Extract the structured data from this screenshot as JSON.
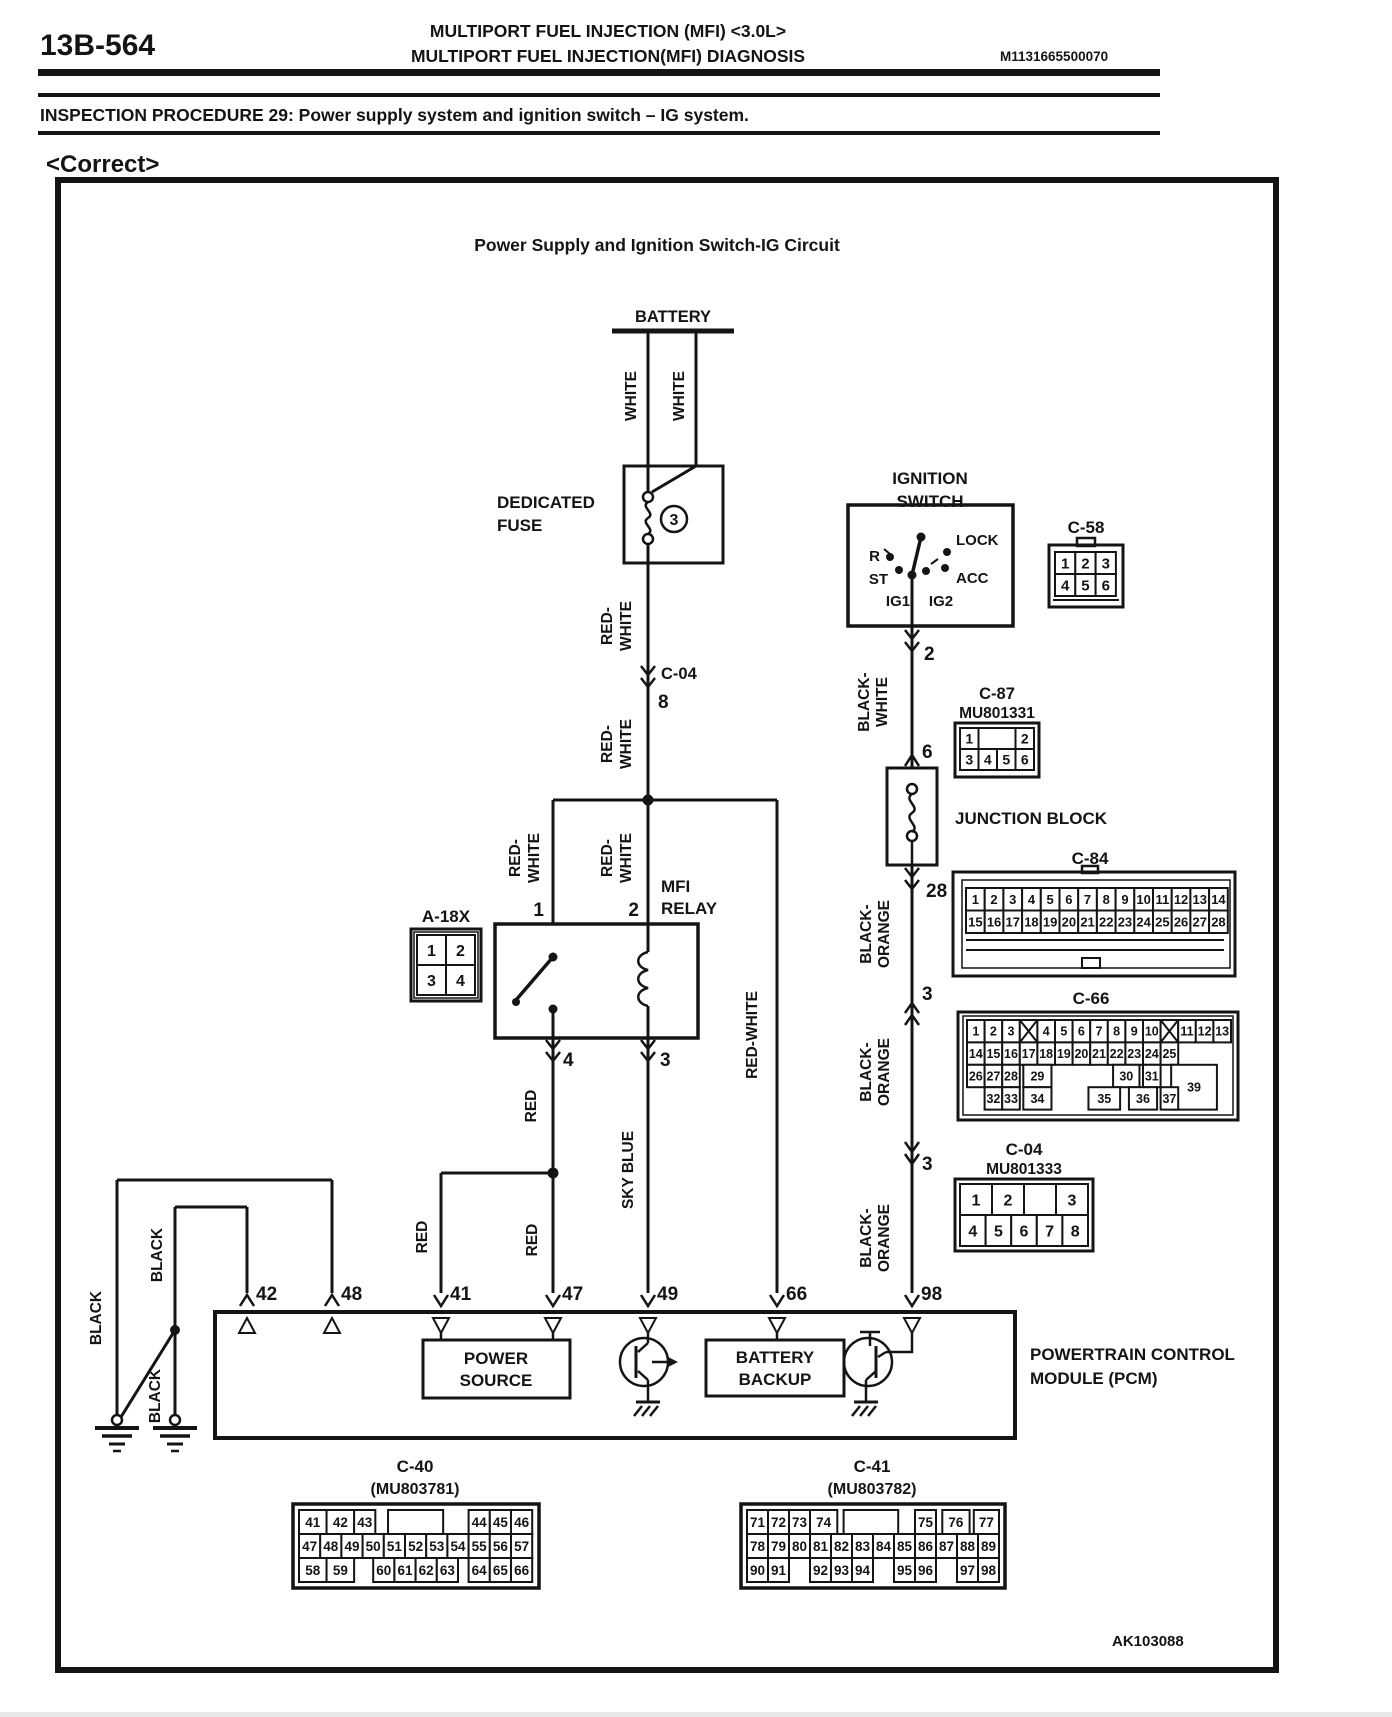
{
  "header": {
    "page_number": "13B-564",
    "title_line1": "MULTIPORT FUEL INJECTION (MFI) <3.0L>",
    "title_line2": "MULTIPORT FUEL INJECTION(MFI) DIAGNOSIS",
    "doc_code": "M1131665500070",
    "procedure": "INSPECTION PROCEDURE 29: Power supply system and ignition switch – IG system.",
    "verdict": "<Correct>"
  },
  "diagram": {
    "title": "Power Supply and Ignition Switch-IG Circuit",
    "figure_code": "AK103088",
    "battery_label": "BATTERY",
    "fuse": {
      "line1": "DEDICATED",
      "line2": "FUSE",
      "number": "3"
    },
    "ignition_switch": {
      "line1": "IGNITION",
      "line2": "SWITCH",
      "lock": "LOCK",
      "r": "R",
      "st": "ST",
      "acc": "ACC",
      "ig1": "IG1",
      "ig2": "IG2"
    },
    "relay": {
      "line1": "MFI",
      "line2": "RELAY",
      "pin1": "1",
      "pin2": "2",
      "pin3": "3",
      "pin4": "4"
    },
    "junction_block": "JUNCTION BLOCK",
    "pcm": {
      "line1": "POWERTRAIN CONTROL",
      "line2": "MODULE (PCM)",
      "ps1": "POWER",
      "ps2": "SOURCE",
      "bb1": "BATTERY",
      "bb2": "BACKUP"
    },
    "wires": {
      "white": "WHITE",
      "rw_l1": "RED-",
      "rw_l2": "WHITE",
      "red_white": "RED-WHITE",
      "red": "RED",
      "sky_blue": "SKY BLUE",
      "bw_l1": "BLACK-",
      "bw_l2": "WHITE",
      "bo_l1": "BLACK-",
      "bo_l2": "ORANGE",
      "black": "BLACK"
    },
    "pins": {
      "via_c04_top": "8",
      "ign_out": "2",
      "jb_in": "6",
      "jb_out": "28",
      "via_c66": "3",
      "via_c04": "3",
      "p42": "42",
      "p48": "48",
      "p41": "41",
      "p47": "47",
      "p49": "49",
      "p66": "66",
      "p98": "98"
    }
  },
  "connectors": {
    "c58": {
      "label": "C-58",
      "rows": [
        [
          "1",
          "2",
          "3"
        ],
        [
          "4",
          "5",
          "6"
        ]
      ]
    },
    "c87": {
      "label": "C-87",
      "part": "MU801331",
      "rows": [
        [
          {
            "t": "1"
          },
          {
            "t": "",
            "w": 2
          },
          {
            "t": "2"
          }
        ],
        [
          "3",
          "4",
          "5",
          "6"
        ]
      ]
    },
    "c84": {
      "label": "C-84",
      "rows": [
        [
          "1",
          "2",
          "3",
          "4",
          "5",
          "6",
          "7",
          "8",
          "9",
          "10",
          "11",
          "12",
          "13",
          "14"
        ],
        [
          "15",
          "16",
          "17",
          "18",
          "19",
          "20",
          "21",
          "22",
          "23",
          "24",
          "25",
          "26",
          "27",
          "28"
        ]
      ]
    },
    "c66": {
      "label": "C-66",
      "rows": [
        [
          "1",
          "2",
          "3",
          "X",
          "4",
          "5",
          "6",
          "7",
          "8",
          "9",
          "10",
          "X",
          "11",
          "12",
          "13"
        ],
        [
          "14",
          "15",
          "16",
          "17",
          "18",
          "19",
          "20",
          "21",
          "22",
          "23",
          "24",
          "25"
        ],
        [
          "26",
          "27",
          "28",
          {
            "t": "29",
            "x": 3.2,
            "w": 1.6
          },
          {
            "t": "30",
            "x": 8.3,
            "w": 1.5
          },
          {
            "t": "31",
            "x": 10
          },
          {
            "t": "39",
            "x": 11.6,
            "w": 2.6,
            "h": 2
          }
        ],
        [
          {
            "t": "32",
            "x": 1
          },
          {
            "t": "33",
            "x": 2
          },
          {
            "t": "34",
            "x": 3.2,
            "w": 1.6
          },
          {
            "t": "35",
            "x": 6.9,
            "w": 1.8
          },
          {
            "t": "36",
            "x": 9.2,
            "w": 1.6
          },
          {
            "t": "37",
            "x": 11
          }
        ]
      ]
    },
    "c04": {
      "label": "C-04",
      "part": "MU801333",
      "rows": [
        [
          {
            "t": "1",
            "w": 1.25
          },
          {
            "t": "2",
            "w": 1.25
          },
          {
            "t": "",
            "w": 1.25
          },
          {
            "t": "3",
            "w": 1.25
          }
        ],
        [
          "4",
          "5",
          "6",
          "7",
          "8"
        ]
      ]
    },
    "a18x": {
      "label": "A-18X",
      "rows": [
        [
          "1",
          "2"
        ],
        [
          "3",
          "4"
        ]
      ]
    },
    "c40": {
      "label": "C-40",
      "part": "(MU803781)",
      "rows": [
        [
          {
            "t": "41",
            "w": 1.3
          },
          {
            "t": "42",
            "w": 1.3
          },
          {
            "t": "43"
          },
          {
            "t": "",
            "x": 4.2,
            "w": 2.6
          },
          {
            "t": "44",
            "x": 8
          },
          {
            "t": "45"
          },
          {
            "t": "46"
          }
        ],
        [
          "47",
          "48",
          "49",
          "50",
          "51",
          "52",
          "53",
          "54",
          "55",
          "56",
          "57"
        ],
        [
          {
            "t": "58",
            "w": 1.3
          },
          {
            "t": "59",
            "w": 1.3
          },
          {
            "t": "60",
            "x": 3.5
          },
          {
            "t": "61"
          },
          {
            "t": "62"
          },
          {
            "t": "63"
          },
          {
            "t": "64",
            "x": 8
          },
          {
            "t": "65"
          },
          {
            "t": "66"
          }
        ]
      ]
    },
    "c41": {
      "label": "C-41",
      "part": "(MU803782)",
      "rows": [
        [
          {
            "t": "71"
          },
          {
            "t": "72"
          },
          {
            "t": "73"
          },
          {
            "t": "74",
            "w": 1.3
          },
          {
            "t": "",
            "x": 4.6,
            "w": 2.6
          },
          {
            "t": "75",
            "x": 8
          },
          {
            "t": "76",
            "x": 9.3,
            "w": 1.3
          },
          {
            "t": "77",
            "x": 10.8,
            "w": 1.2
          }
        ],
        [
          "78",
          "79",
          "80",
          "81",
          "82",
          "83",
          "84",
          "85",
          "86",
          "87",
          "88",
          "89"
        ],
        [
          {
            "t": "90"
          },
          {
            "t": "91"
          },
          {
            "t": "92",
            "x": 3
          },
          {
            "t": "93"
          },
          {
            "t": "94"
          },
          {
            "t": "95",
            "x": 7
          },
          {
            "t": "96"
          },
          {
            "t": "97",
            "x": 10
          },
          {
            "t": "98",
            "x": 11
          }
        ]
      ]
    }
  }
}
